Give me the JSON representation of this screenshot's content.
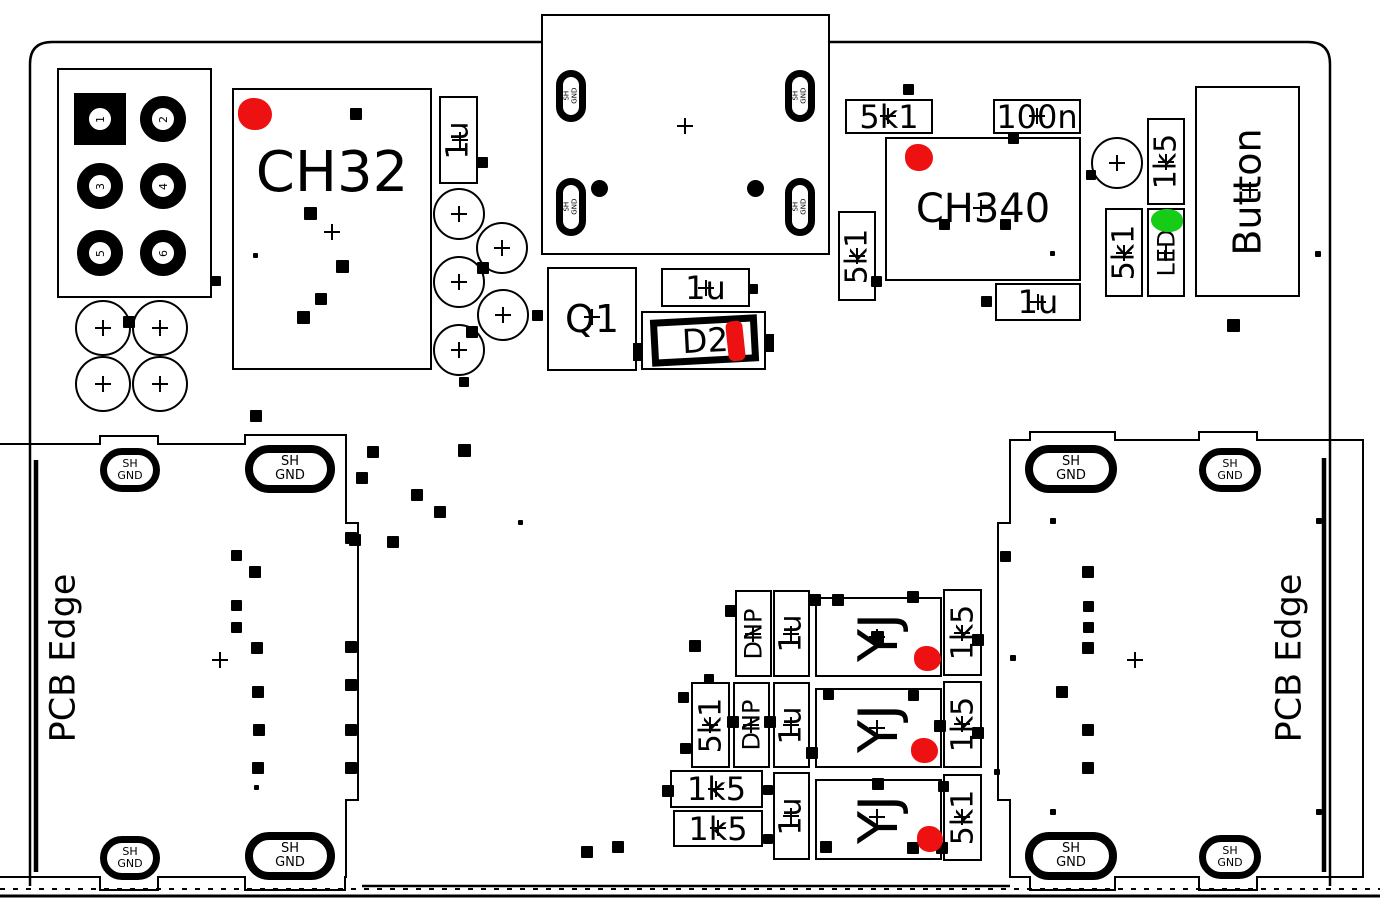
{
  "texts": {
    "ch32": "CH32",
    "ch340": "CH340",
    "button": "Button",
    "q1": "Q1",
    "d2": "D2",
    "yj": "YJ",
    "pcb_edge_left": "PCB Edge",
    "pcb_edge_right": "PCB Edge",
    "shield_line1": "SH",
    "shield_line2": "GND",
    "shield_full": "SH GND"
  },
  "colors": {
    "line": "#000000",
    "highlight_red": "#ee1111",
    "highlight_green": "#16cc16",
    "bg": "#ffffff"
  },
  "header_pins": [
    "1",
    "2",
    "3",
    "4",
    "5",
    "6"
  ],
  "header_pin_pads": [
    [
      100,
      119
    ],
    [
      163,
      119
    ],
    [
      100,
      186
    ],
    [
      163,
      186
    ],
    [
      100,
      253
    ],
    [
      163,
      253
    ]
  ],
  "label_boxes": [
    {
      "text": "1u",
      "x": 439,
      "y": 96,
      "w": 39,
      "h": 88,
      "v": true,
      "fs": 30
    },
    {
      "text": "5k1",
      "x": 845,
      "y": 99,
      "w": 88,
      "h": 35,
      "v": false,
      "fs": 32
    },
    {
      "text": "100n",
      "x": 993,
      "y": 99,
      "w": 88,
      "h": 35,
      "v": false,
      "fs": 32
    },
    {
      "text": "5k1",
      "x": 838,
      "y": 211,
      "w": 38,
      "h": 90,
      "v": true,
      "fs": 30
    },
    {
      "text": "1u",
      "x": 995,
      "y": 283,
      "w": 86,
      "h": 38,
      "v": false,
      "fs": 32
    },
    {
      "text": "1u",
      "x": 661,
      "y": 268,
      "w": 89,
      "h": 39,
      "v": false,
      "fs": 32
    },
    {
      "text": "1k5",
      "x": 1147,
      "y": 118,
      "w": 38,
      "h": 87,
      "v": true,
      "fs": 30
    },
    {
      "text": "5k1",
      "x": 1105,
      "y": 208,
      "w": 38,
      "h": 89,
      "v": true,
      "fs": 30
    },
    {
      "text": "LED",
      "x": 1147,
      "y": 208,
      "w": 38,
      "h": 89,
      "v": true,
      "fs": 24
    },
    {
      "text": "DNP",
      "x": 735,
      "y": 590,
      "w": 37,
      "h": 87,
      "v": true,
      "fs": 24
    },
    {
      "text": "1u",
      "x": 773,
      "y": 590,
      "w": 37,
      "h": 87,
      "v": true,
      "fs": 30
    },
    {
      "text": "1k5",
      "x": 943,
      "y": 589,
      "w": 39,
      "h": 87,
      "v": true,
      "fs": 30
    },
    {
      "text": "5k1",
      "x": 691,
      "y": 682,
      "w": 39,
      "h": 86,
      "v": true,
      "fs": 30
    },
    {
      "text": "DNP",
      "x": 733,
      "y": 682,
      "w": 37,
      "h": 86,
      "v": true,
      "fs": 24
    },
    {
      "text": "1u",
      "x": 773,
      "y": 682,
      "w": 37,
      "h": 86,
      "v": true,
      "fs": 30
    },
    {
      "text": "1k5",
      "x": 943,
      "y": 681,
      "w": 39,
      "h": 87,
      "v": true,
      "fs": 30
    },
    {
      "text": "1k5",
      "x": 670,
      "y": 770,
      "w": 93,
      "h": 38,
      "v": false,
      "fs": 32
    },
    {
      "text": "1k5",
      "x": 673,
      "y": 810,
      "w": 90,
      "h": 37,
      "v": false,
      "fs": 32
    },
    {
      "text": "1u",
      "x": 773,
      "y": 772,
      "w": 37,
      "h": 88,
      "v": true,
      "fs": 30
    },
    {
      "text": "5k1",
      "x": 943,
      "y": 774,
      "w": 39,
      "h": 87,
      "v": true,
      "fs": 30
    }
  ],
  "yj_boxes": [
    [
      815,
      597,
      127,
      80
    ],
    [
      815,
      688,
      127,
      80
    ],
    [
      815,
      779,
      127,
      81
    ]
  ],
  "shield_ovals": [
    [
      100,
      448,
      60,
      44,
      11
    ],
    [
      245,
      445,
      90,
      48,
      13
    ],
    [
      100,
      836,
      60,
      44,
      11
    ],
    [
      245,
      832,
      90,
      48,
      13
    ],
    [
      1025,
      445,
      92,
      48,
      13
    ],
    [
      1199,
      448,
      62,
      44,
      11
    ],
    [
      1025,
      832,
      92,
      48,
      13
    ],
    [
      1199,
      835,
      62,
      44,
      11
    ]
  ],
  "usb_ovals": [
    [
      556,
      70,
      30,
      52
    ],
    [
      785,
      70,
      30,
      52
    ],
    [
      556,
      178,
      30,
      58
    ],
    [
      785,
      178,
      30,
      58
    ]
  ],
  "circles": [
    [
      103,
      328,
      28
    ],
    [
      160,
      328,
      28
    ],
    [
      103,
      384,
      28
    ],
    [
      160,
      384,
      28
    ],
    [
      459,
      214,
      26
    ],
    [
      502,
      248,
      26
    ],
    [
      459,
      282,
      26
    ],
    [
      503,
      315,
      26
    ],
    [
      459,
      350,
      26
    ],
    [
      1117,
      163,
      26
    ]
  ],
  "crosshairs": [
    [
      685,
      126
    ],
    [
      332,
      232
    ],
    [
      592,
      317
    ],
    [
      220,
      660
    ],
    [
      1135,
      660
    ],
    [
      1250,
      190
    ],
    [
      981,
      208
    ],
    [
      460,
      140
    ],
    [
      888,
      116
    ],
    [
      1037,
      116
    ],
    [
      857,
      256
    ],
    [
      1038,
      302
    ],
    [
      706,
      288
    ],
    [
      1166,
      162
    ],
    [
      1124,
      253
    ],
    [
      1166,
      253
    ],
    [
      753,
      634
    ],
    [
      791,
      634
    ],
    [
      962,
      633
    ],
    [
      710,
      725
    ],
    [
      751,
      725
    ],
    [
      791,
      725
    ],
    [
      962,
      724
    ],
    [
      716,
      789
    ],
    [
      718,
      828
    ],
    [
      791,
      816
    ],
    [
      962,
      817
    ],
    [
      877,
      637
    ],
    [
      877,
      728
    ],
    [
      877,
      817
    ],
    [
      103,
      328
    ],
    [
      160,
      328
    ],
    [
      103,
      384
    ],
    [
      160,
      384
    ],
    [
      459,
      214
    ],
    [
      502,
      248
    ],
    [
      459,
      282
    ],
    [
      503,
      315
    ],
    [
      459,
      350
    ],
    [
      1117,
      163
    ]
  ],
  "dots": [
    [
      356,
      114,
      12
    ],
    [
      310,
      213,
      13
    ],
    [
      342,
      266,
      13
    ],
    [
      321,
      299,
      12
    ],
    [
      303,
      317,
      13
    ],
    [
      255,
      255,
      5
    ],
    [
      216,
      281,
      10
    ],
    [
      129,
      322,
      12
    ],
    [
      482,
      162,
      11
    ],
    [
      483,
      268,
      12
    ],
    [
      472,
      332,
      12
    ],
    [
      537,
      315,
      11
    ],
    [
      464,
      382,
      10
    ],
    [
      753,
      289,
      10
    ],
    [
      908,
      89,
      11
    ],
    [
      1013,
      138,
      11
    ],
    [
      944,
      224,
      11
    ],
    [
      1005,
      224,
      11
    ],
    [
      1052,
      253,
      5
    ],
    [
      876,
      281,
      11
    ],
    [
      986,
      301,
      11
    ],
    [
      1091,
      175,
      10
    ],
    [
      1233,
      325,
      13
    ],
    [
      1318,
      254,
      6
    ],
    [
      731,
      611,
      12
    ],
    [
      695,
      646,
      12
    ],
    [
      709,
      679,
      10
    ],
    [
      815,
      600,
      12
    ],
    [
      838,
      600,
      12
    ],
    [
      913,
      597,
      12
    ],
    [
      877,
      637,
      13
    ],
    [
      978,
      640,
      12
    ],
    [
      683,
      697,
      11
    ],
    [
      685,
      748,
      11
    ],
    [
      733,
      722,
      12
    ],
    [
      770,
      722,
      12
    ],
    [
      828,
      694,
      11
    ],
    [
      913,
      695,
      11
    ],
    [
      940,
      726,
      12
    ],
    [
      978,
      733,
      12
    ],
    [
      812,
      753,
      12
    ],
    [
      668,
      791,
      12
    ],
    [
      768,
      790,
      10
    ],
    [
      768,
      839,
      10
    ],
    [
      878,
      784,
      12
    ],
    [
      826,
      847,
      12
    ],
    [
      913,
      848,
      12
    ],
    [
      942,
      848,
      12
    ],
    [
      943,
      786,
      11
    ],
    [
      997,
      772,
      6
    ],
    [
      1013,
      658,
      6
    ],
    [
      256,
      416,
      12
    ],
    [
      373,
      452,
      12
    ],
    [
      362,
      478,
      12
    ],
    [
      417,
      495,
      12
    ],
    [
      440,
      512,
      12
    ],
    [
      464,
      450,
      13
    ],
    [
      393,
      542,
      12
    ],
    [
      355,
      540,
      12
    ],
    [
      520,
      522,
      5
    ],
    [
      236,
      555,
      11
    ],
    [
      255,
      572,
      12
    ],
    [
      236,
      605,
      11
    ],
    [
      236,
      627,
      11
    ],
    [
      257,
      648,
      12
    ],
    [
      258,
      692,
      12
    ],
    [
      259,
      730,
      12
    ],
    [
      258,
      768,
      12
    ],
    [
      256,
      787,
      5
    ],
    [
      351,
      538,
      12
    ],
    [
      351,
      647,
      12
    ],
    [
      351,
      685,
      12
    ],
    [
      351,
      730,
      12
    ],
    [
      351,
      768,
      12
    ],
    [
      587,
      852,
      12
    ],
    [
      618,
      847,
      12
    ],
    [
      1005,
      556,
      11
    ],
    [
      1088,
      572,
      12
    ],
    [
      1088,
      606,
      11
    ],
    [
      1088,
      627,
      11
    ],
    [
      1088,
      648,
      12
    ],
    [
      1062,
      692,
      12
    ],
    [
      1088,
      730,
      12
    ],
    [
      1088,
      768,
      12
    ],
    [
      1053,
      521,
      6
    ],
    [
      1319,
      521,
      6
    ],
    [
      1053,
      812,
      6
    ],
    [
      1319,
      812,
      6
    ],
    [
      599,
      188,
      17
    ],
    [
      755,
      188,
      17
    ]
  ],
  "red_blobs": [
    [
      238,
      98,
      34,
      32
    ],
    [
      905,
      144,
      28,
      27
    ],
    [
      914,
      646,
      27,
      25
    ],
    [
      911,
      738,
      27,
      25
    ],
    [
      917,
      826,
      26,
      26
    ]
  ],
  "green_blob": [
    1151,
    209,
    32,
    23
  ],
  "d2_parts": {
    "outer": [
      641,
      311,
      125,
      59
    ],
    "inner": [
      651,
      317,
      107,
      47
    ],
    "blob": [
      727,
      321,
      17,
      40
    ],
    "bumps": [
      [
        633,
        343,
        10,
        18
      ],
      [
        764,
        334,
        10,
        18
      ]
    ]
  }
}
